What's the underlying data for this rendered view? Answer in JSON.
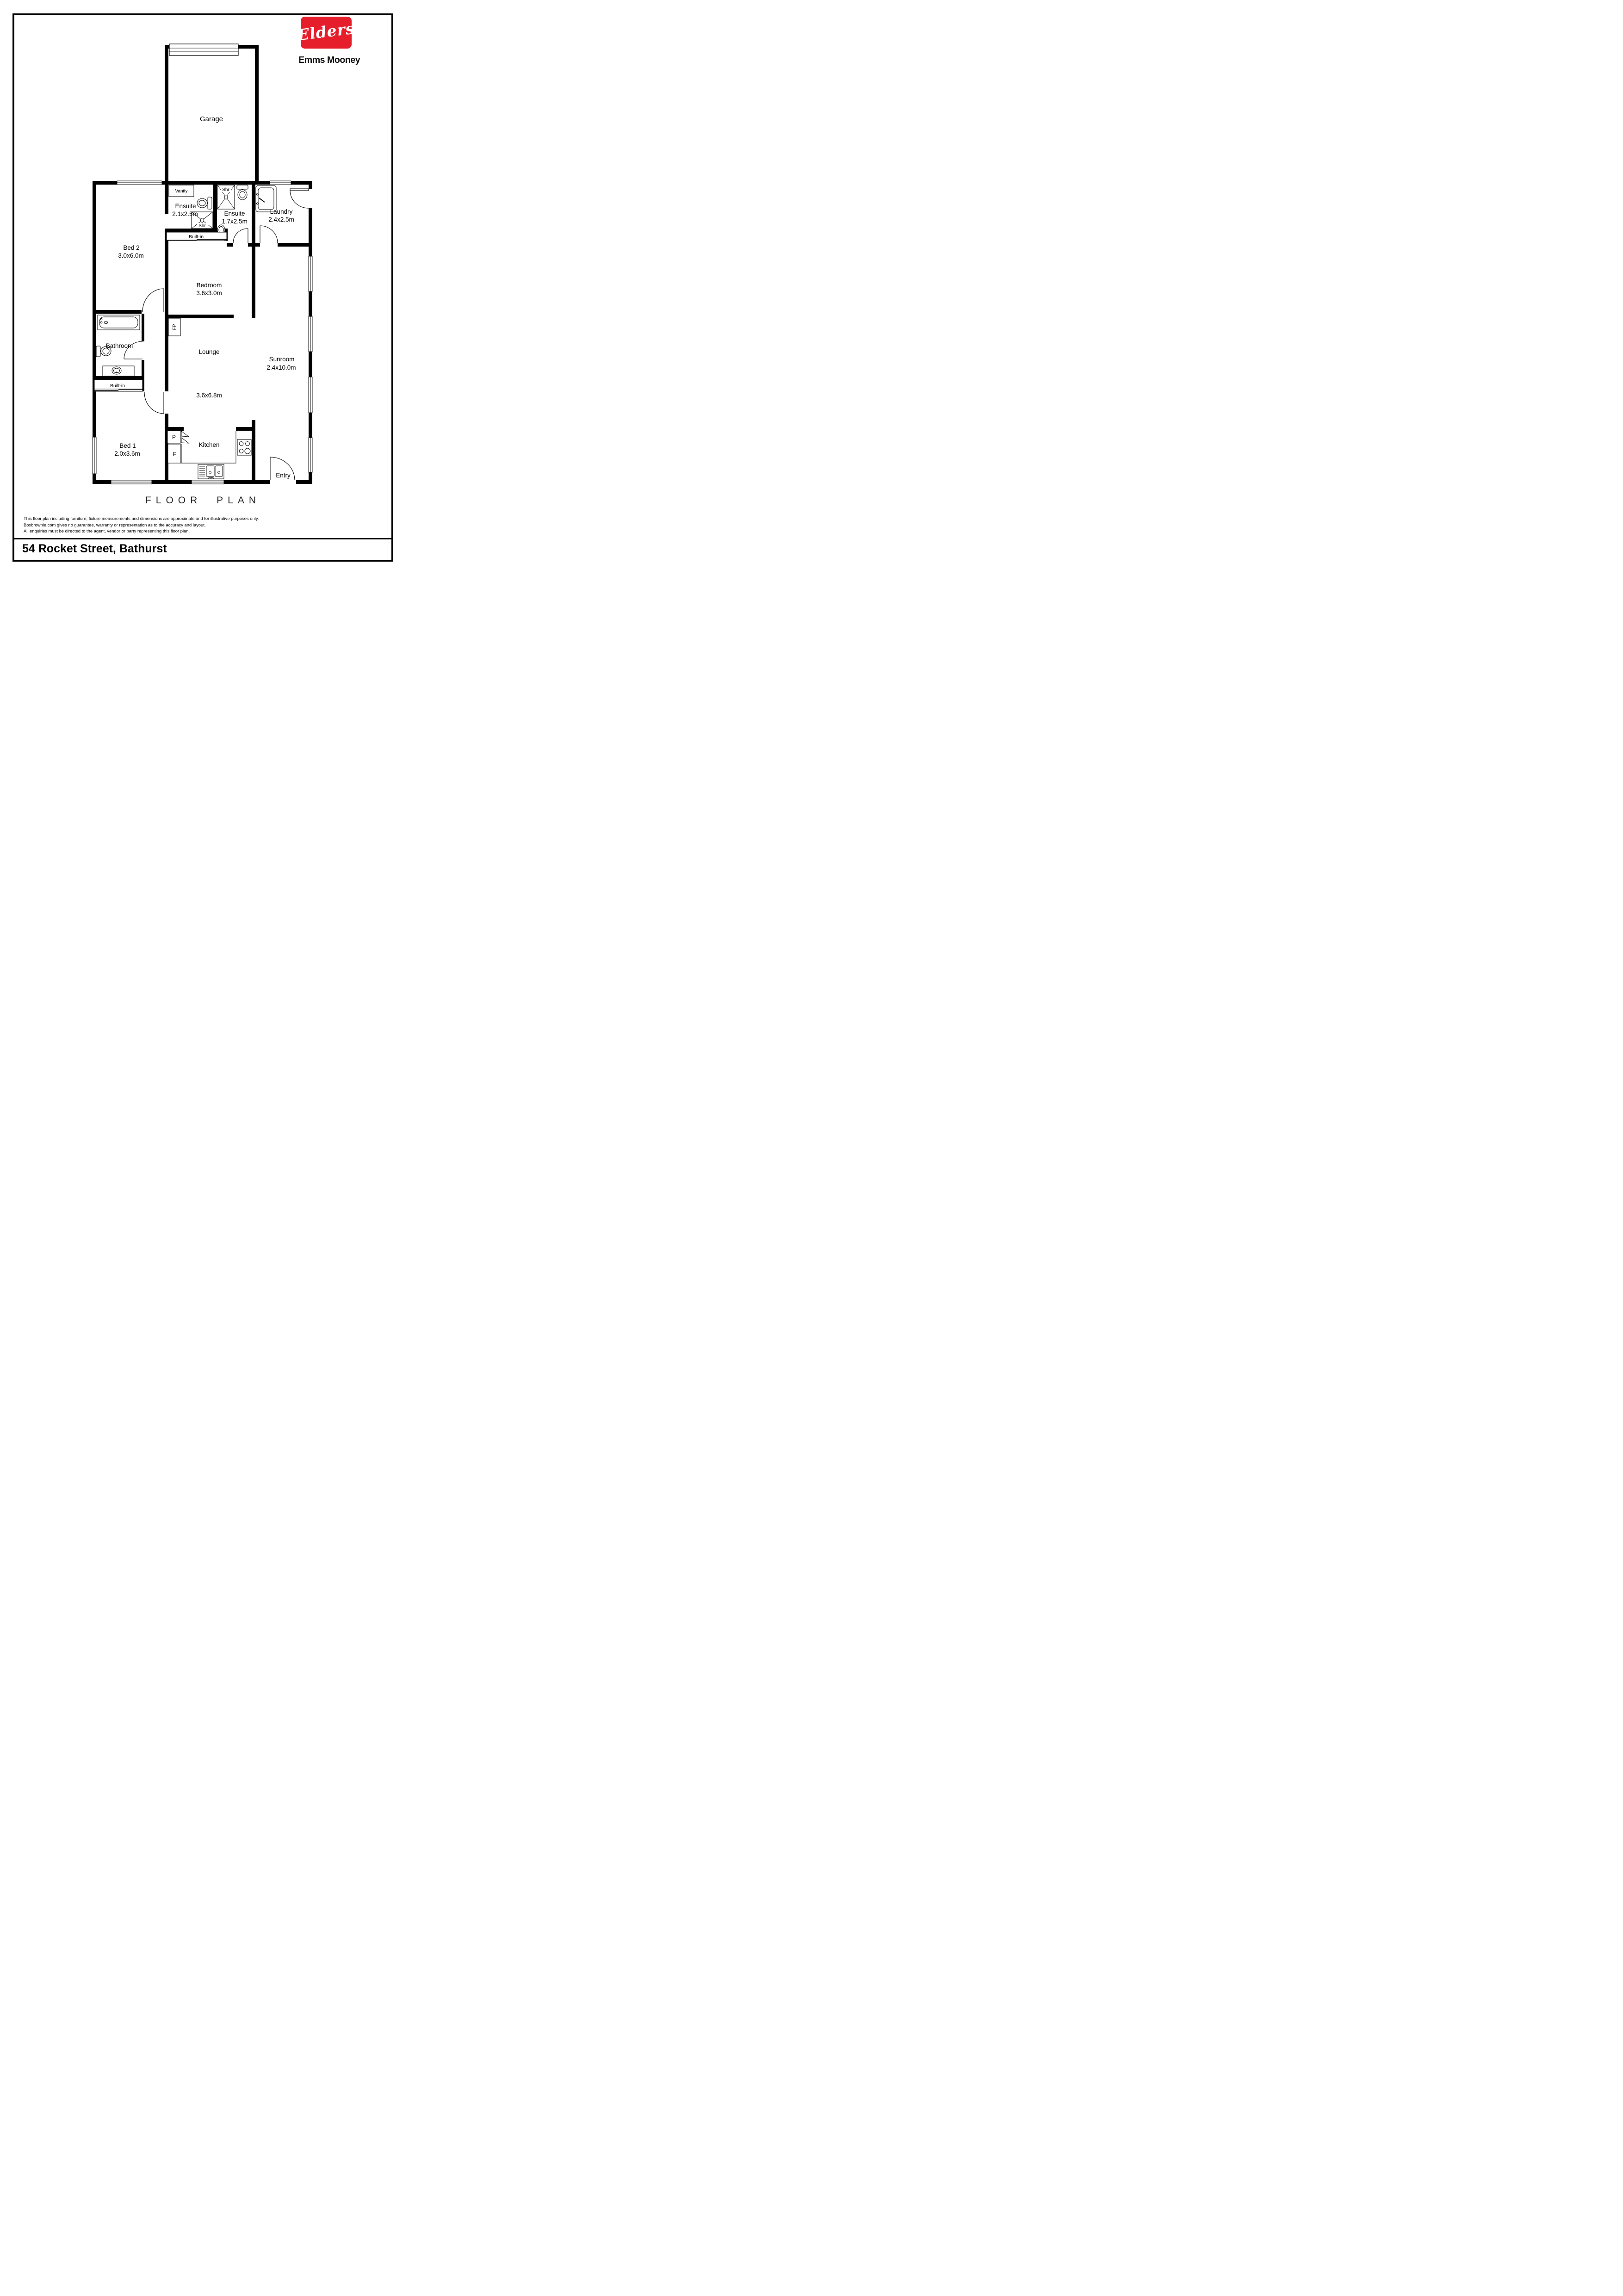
{
  "brand": {
    "logo_text": "Elders",
    "agency_name": "Emms Mooney",
    "brand_red": "#E61E2B"
  },
  "plan": {
    "rooms": [
      {
        "name": "Garage",
        "dims": ""
      },
      {
        "name": "Bed 2",
        "dims": "3.0x6.0m"
      },
      {
        "name": "Ensuite",
        "dims": "2.1x2.5m"
      },
      {
        "name": "Ensuite",
        "dims": "1.7x2.5m"
      },
      {
        "name": "Laundry",
        "dims": "2.4x2.5m"
      },
      {
        "name": "Bedroom",
        "dims": "3.6x3.0m"
      },
      {
        "name": "Bathroom",
        "dims": ""
      },
      {
        "name": "Lounge",
        "dims": "3.6x6.8m"
      },
      {
        "name": "Sunroom",
        "dims": "2.4x10.0m"
      },
      {
        "name": "Bed 1",
        "dims": "2.0x3.6m"
      },
      {
        "name": "Kitchen",
        "dims": ""
      },
      {
        "name": "Entry",
        "dims": ""
      }
    ],
    "fixtures": {
      "vanity": "Vanity",
      "shower_label": "Shr",
      "built_in": "Built-in",
      "fireplace": "FP",
      "pantry": "P",
      "fridge": "F"
    }
  },
  "footer": {
    "title": "FLOOR PLAN",
    "disclaimer_lines": [
      "This floor plan including furniture, fixture measurements and dimensions are approximate and for illustrative purposes only.",
      "Boxbrownie.com gives no guarantee, warranty or representation as to the accuracy and layout.",
      "All enquiries must be directed to the agent, vendor or party representing this floor plan."
    ],
    "address": "54 Rocket Street, Bathurst"
  }
}
